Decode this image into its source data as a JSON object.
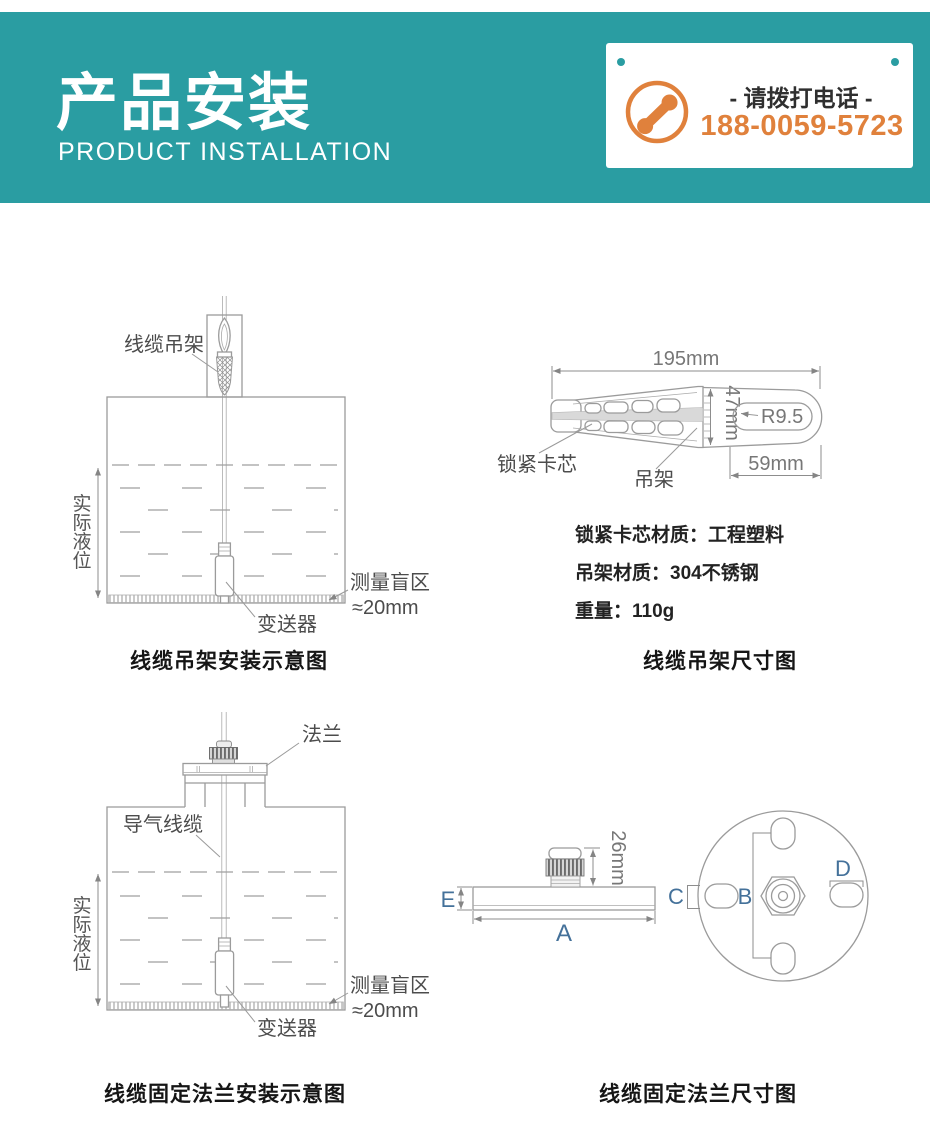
{
  "header": {
    "title": "产品安装",
    "subtitle": "PRODUCT INSTALLATION",
    "phone": {
      "cta": "- 请拨打电话 -",
      "number": "188-0059-5723"
    }
  },
  "colors": {
    "teal": "#2a9da2",
    "orange": "#e0813c",
    "letter_blue": "#44719a"
  },
  "hanger_install": {
    "caption": "线缆吊架安装示意图",
    "hanger_label": "线缆吊架",
    "level": "实际液位",
    "level_chars": [
      "实",
      "际",
      "液",
      "位"
    ],
    "blind_line1": "测量盲区",
    "blind_line2": "≈20mm",
    "transmitter": "变送器"
  },
  "hanger_dims": {
    "caption": "线缆吊架尺寸图",
    "length": "195mm",
    "height": "47mm",
    "radius": "R9.5",
    "slot_width": "59mm",
    "lock_core": "锁紧卡芯",
    "hanger": "吊架",
    "specs": [
      "锁紧卡芯材质：工程塑料",
      "吊架材质：304不锈钢",
      "重量：110g"
    ]
  },
  "flange_install": {
    "caption": "线缆固定法兰安装示意图",
    "flange": "法兰",
    "vent_cable": "导气线缆",
    "level": "实际液位",
    "level_chars": [
      "实",
      "际",
      "液",
      "位"
    ],
    "blind_line1": "测量盲区",
    "blind_line2": "≈20mm",
    "transmitter": "变送器"
  },
  "flange_dims": {
    "caption": "线缆固定法兰尺寸图",
    "gland_height": "26mm",
    "thickness": "E",
    "width": "A",
    "bolt_span": "B",
    "slot": "C",
    "hole": "D"
  }
}
